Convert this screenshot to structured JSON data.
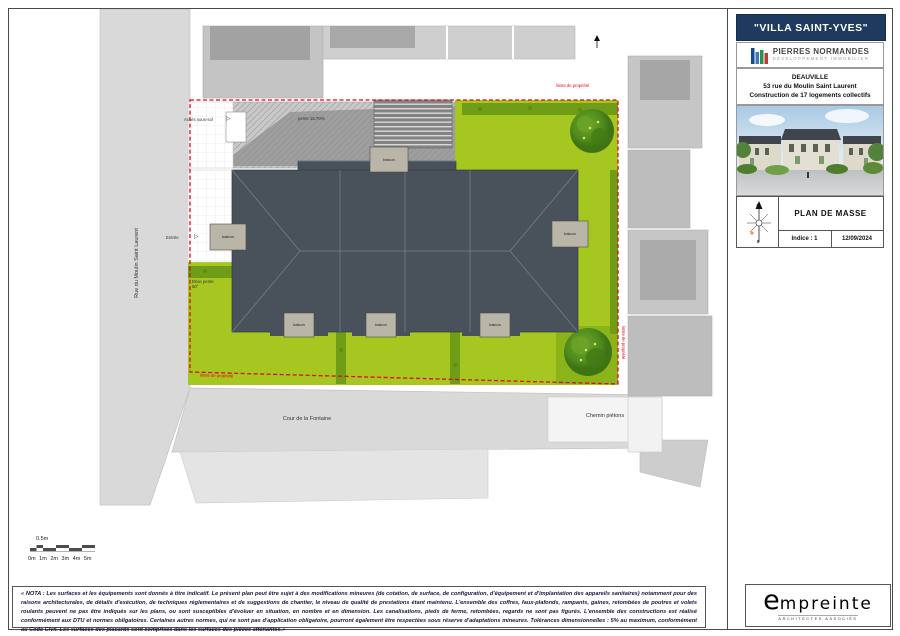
{
  "title_block": {
    "project_title": "\"VILLA SAINT-YVES\"",
    "developer_name": "PIERRES NORMANDES",
    "developer_subtitle": "DÉVELOPPEMENT IMMOBILIER",
    "city": "DEAUVILLE",
    "street": "53 rue du Moulin Saint Laurent",
    "program": "Construction de 17 logements collectifs",
    "drawing_title": "PLAN DE MASSE",
    "indice": "Indice : 1",
    "date": "12/09/2024",
    "compass_north": "N",
    "compass_south": "S"
  },
  "plan": {
    "street_left": "Rue du Moulin Saint Laurent",
    "street_bottom": "Cour de la Fontaine",
    "path_label": "Chemin piétons",
    "basement_access": "Accès sous-sol",
    "ramp_slope": "pente 15.70%",
    "entrance": "Entrée",
    "arrow": "▷",
    "slope_break": "Brise pente 60°",
    "property_limit": "limite de propriété",
    "balcony": "balcon"
  },
  "scale_bar": {
    "half_meter": "0.5m",
    "ticks": "0m 1m 2m 3m 4m 5m"
  },
  "footer": {
    "nota": "« NOTA : Les surfaces et les équipements sont donnés à titre indicatif. Le présent plan peut être sujet à des modifications mineures (de cotation, de surface, de configuration, d'équipement et d'implantation des appareils sanitaires) notamment pour des raisons architecturales, de détails d'exécution, de techniques réglementaires et de suggestions de chantier, le niveau de qualité de prestations étant maintenu. L'ensemble des coffres, faux-plafonds, rampants, gaines, retombées de poutres et volets roulants peuvent ne pas être indiqués sur les plans, ou sont susceptibles d'évoluer en situation, en nombre et en dimension. Les canalisations, pieds de ferme, retombées, regards ne sont pas figurés. L'ensemble des constructions est réalisé conformément aux DTU et normes obligatoires. Certaines autres normes, qui ne sont pas d'application obligatoire, pourront également être respectées sous réserve d'adaptations mineures. Tolérances dimensionnelles : 5% au maximum, conformément au Code Civil. Les surfaces des placards sont comprises dans les surfaces des pièces attenantes.»",
    "architect": "empreinte",
    "architect_tagline": "architectes associés"
  },
  "colors": {
    "boundary_red": "#e30613",
    "site_green": "#a6c71f",
    "roof_gray": "#49525a",
    "header_navy": "#1e3a5f"
  }
}
